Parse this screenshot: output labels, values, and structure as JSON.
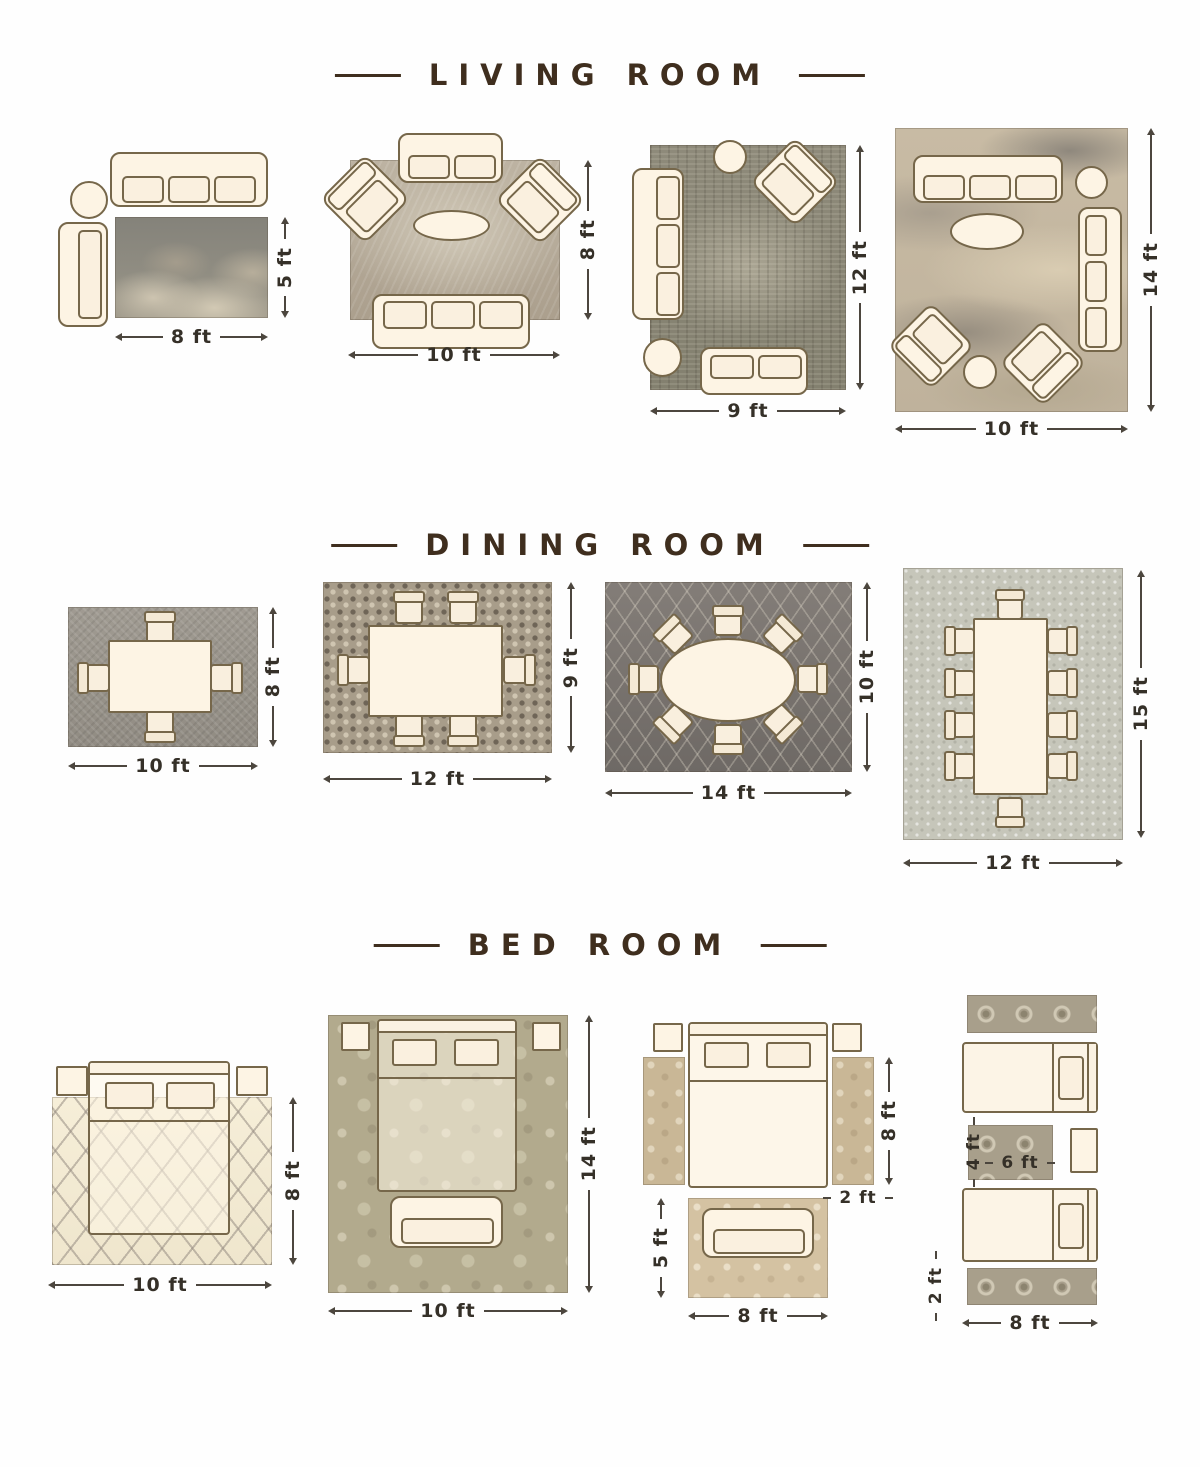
{
  "colors": {
    "title": "#3f2e1e",
    "dimension_text": "#353028",
    "furniture_outline": "#76674a",
    "furniture_fill": "#fdf4e4"
  },
  "sections": {
    "living": {
      "title": "LIVING ROOM",
      "layouts": [
        {
          "width": "8 ft",
          "height": "5 ft"
        },
        {
          "width": "10 ft",
          "height": "8 ft"
        },
        {
          "width": "9 ft",
          "height": "12 ft"
        },
        {
          "width": "10 ft",
          "height": "14 ft"
        }
      ]
    },
    "dining": {
      "title": "DINING ROOM",
      "layouts": [
        {
          "width": "10 ft",
          "height": "8 ft"
        },
        {
          "width": "12 ft",
          "height": "9 ft"
        },
        {
          "width": "14 ft",
          "height": "10 ft"
        },
        {
          "width": "12 ft",
          "height": "15 ft"
        }
      ]
    },
    "bedroom": {
      "title": "BED ROOM",
      "layouts": [
        {
          "width": "10 ft",
          "height": "8 ft"
        },
        {
          "width": "10 ft",
          "height": "14 ft"
        },
        {
          "runner_height": "8 ft",
          "runner_width": "2 ft",
          "front_rug_height": "5 ft",
          "front_rug_width": "8 ft"
        },
        {
          "between_rug_height": "4 ft",
          "between_rug_width": "6 ft",
          "runner_width": "2 ft",
          "runner_length": "8 ft"
        }
      ]
    }
  }
}
